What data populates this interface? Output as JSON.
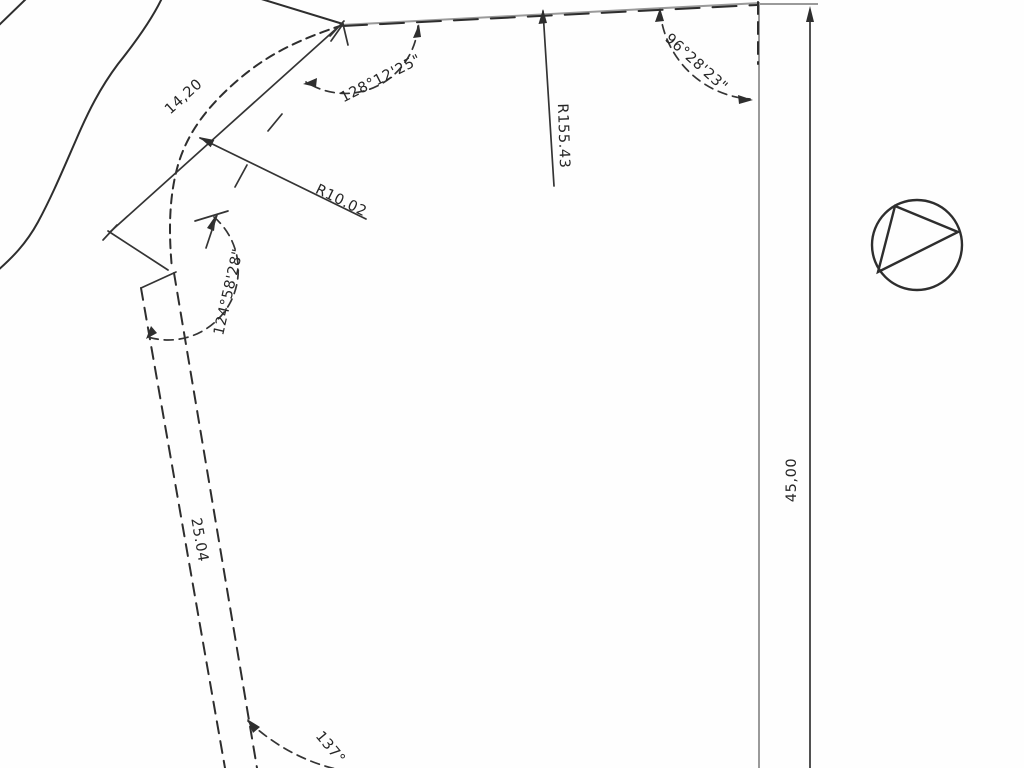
{
  "drawing": {
    "title": "survey-plot-plan",
    "labels": {
      "dim_top_left": "14,20",
      "radius_corner": "R10.02",
      "angle_top_left": "128°12'25\"",
      "angle_top_right": "96°28'23\"",
      "radius_boundary": "R155.43",
      "angle_left": "124°58'28\"",
      "dim_road": "25.04",
      "dim_right": "45,00",
      "angle_bottom": "137°"
    },
    "symbols": {
      "north_symbol": "circle-with-inscribed-triangle"
    },
    "colors": {
      "line": "#2e2e2e",
      "secondary_line": "#9a9a9a",
      "background": "#ffffff",
      "text": "#262626"
    }
  }
}
